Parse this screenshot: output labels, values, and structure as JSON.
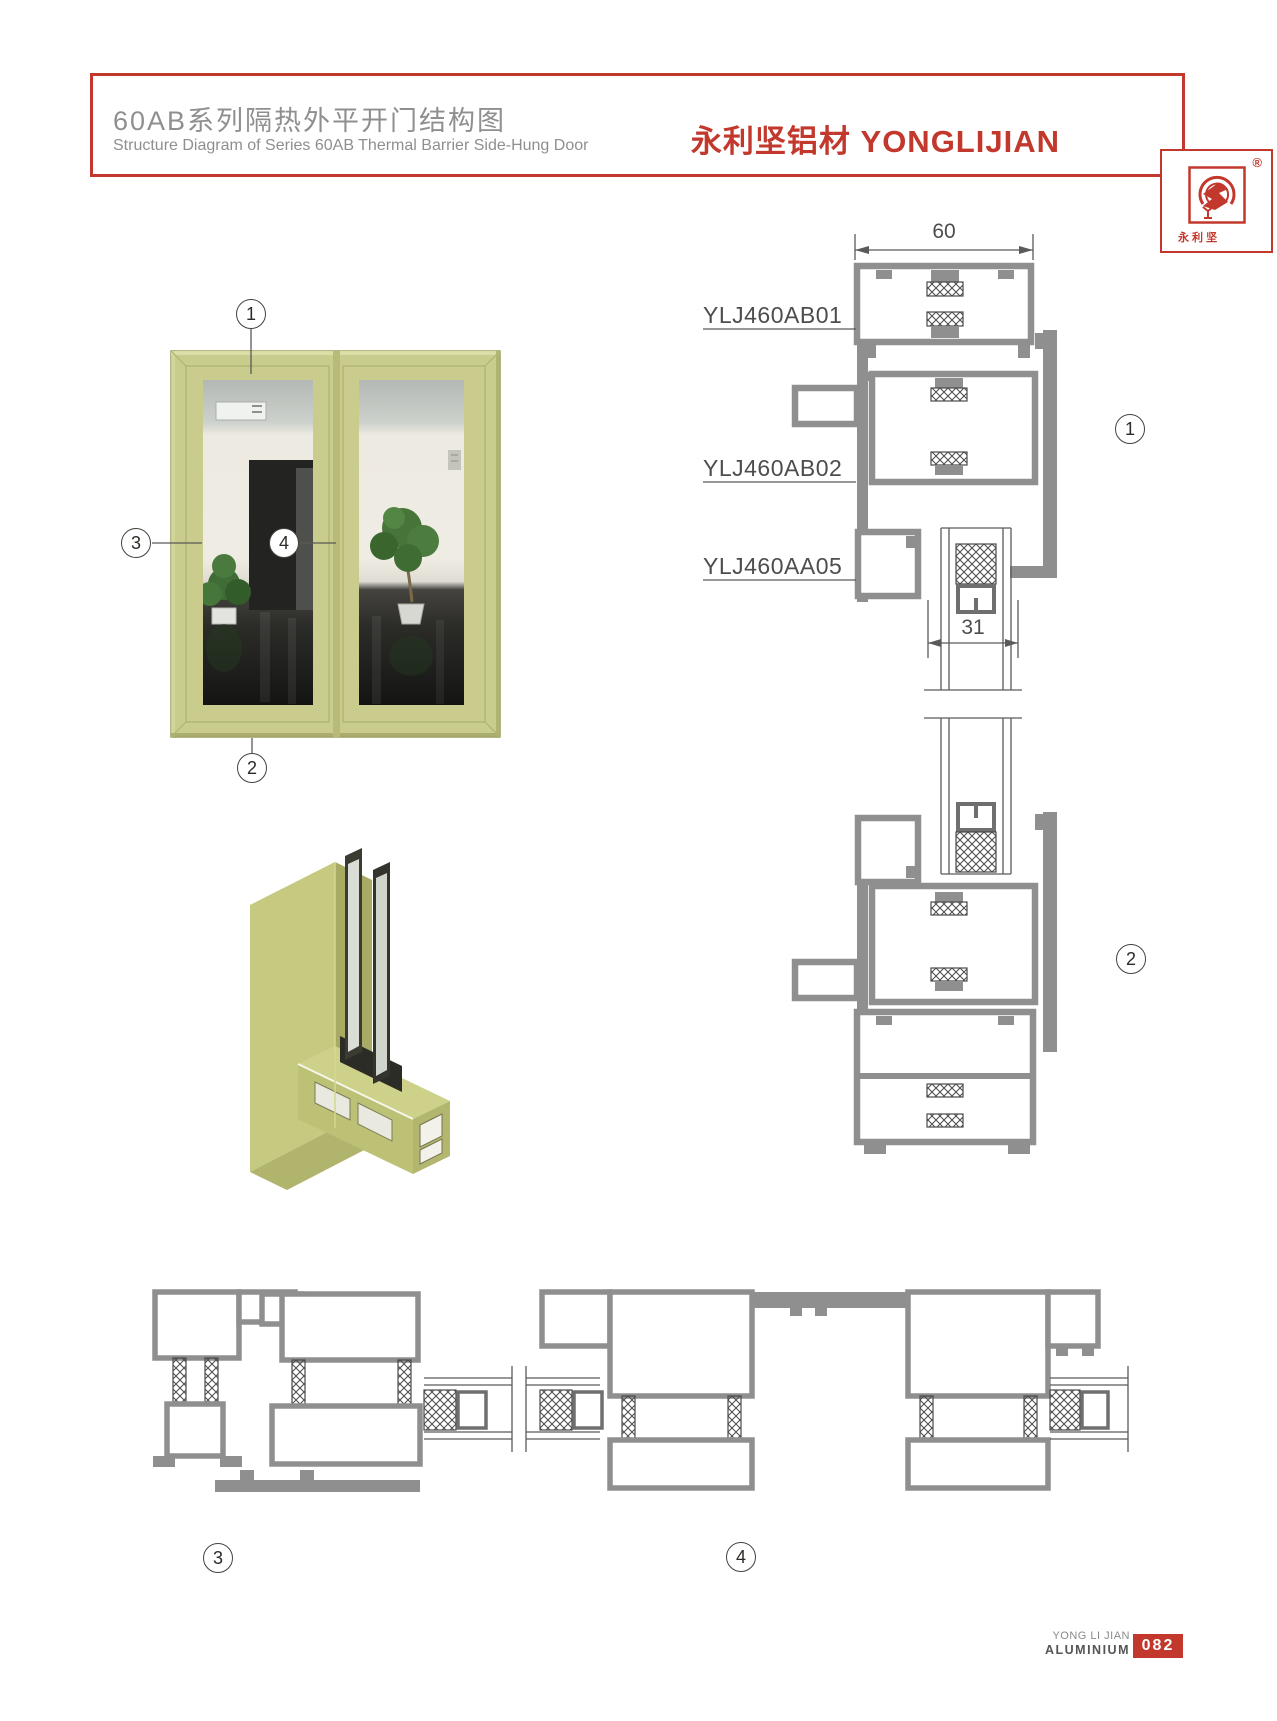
{
  "header": {
    "title_zh": "60AB系列隔热外平开门结构图",
    "subtitle_en": "Structure Diagram of Series 60AB Thermal Barrier Side-Hung Door",
    "brand": "永利坚铝材 YONGLIJIAN",
    "logo": {
      "registered": "®",
      "name_chars": "永 利 坚"
    }
  },
  "drawing": {
    "labels": [
      "YLJ460AB01",
      "YLJ460AB02",
      "YLJ460AA05"
    ],
    "dim_top_width": "60",
    "dim_glass": "31"
  },
  "callouts": {
    "n1": "1",
    "n2": "2",
    "n3": "3",
    "n4": "4"
  },
  "footer": {
    "brand_line1": "YONG LI JIAN",
    "brand_line2": "ALUMINIUM",
    "page_number": "082"
  },
  "colors": {
    "brand_red": "#c2382c",
    "profile_gray": "#8f8f8f",
    "door_olive": "#c9cc8c",
    "hatch_dark": "#4a4a4a"
  }
}
